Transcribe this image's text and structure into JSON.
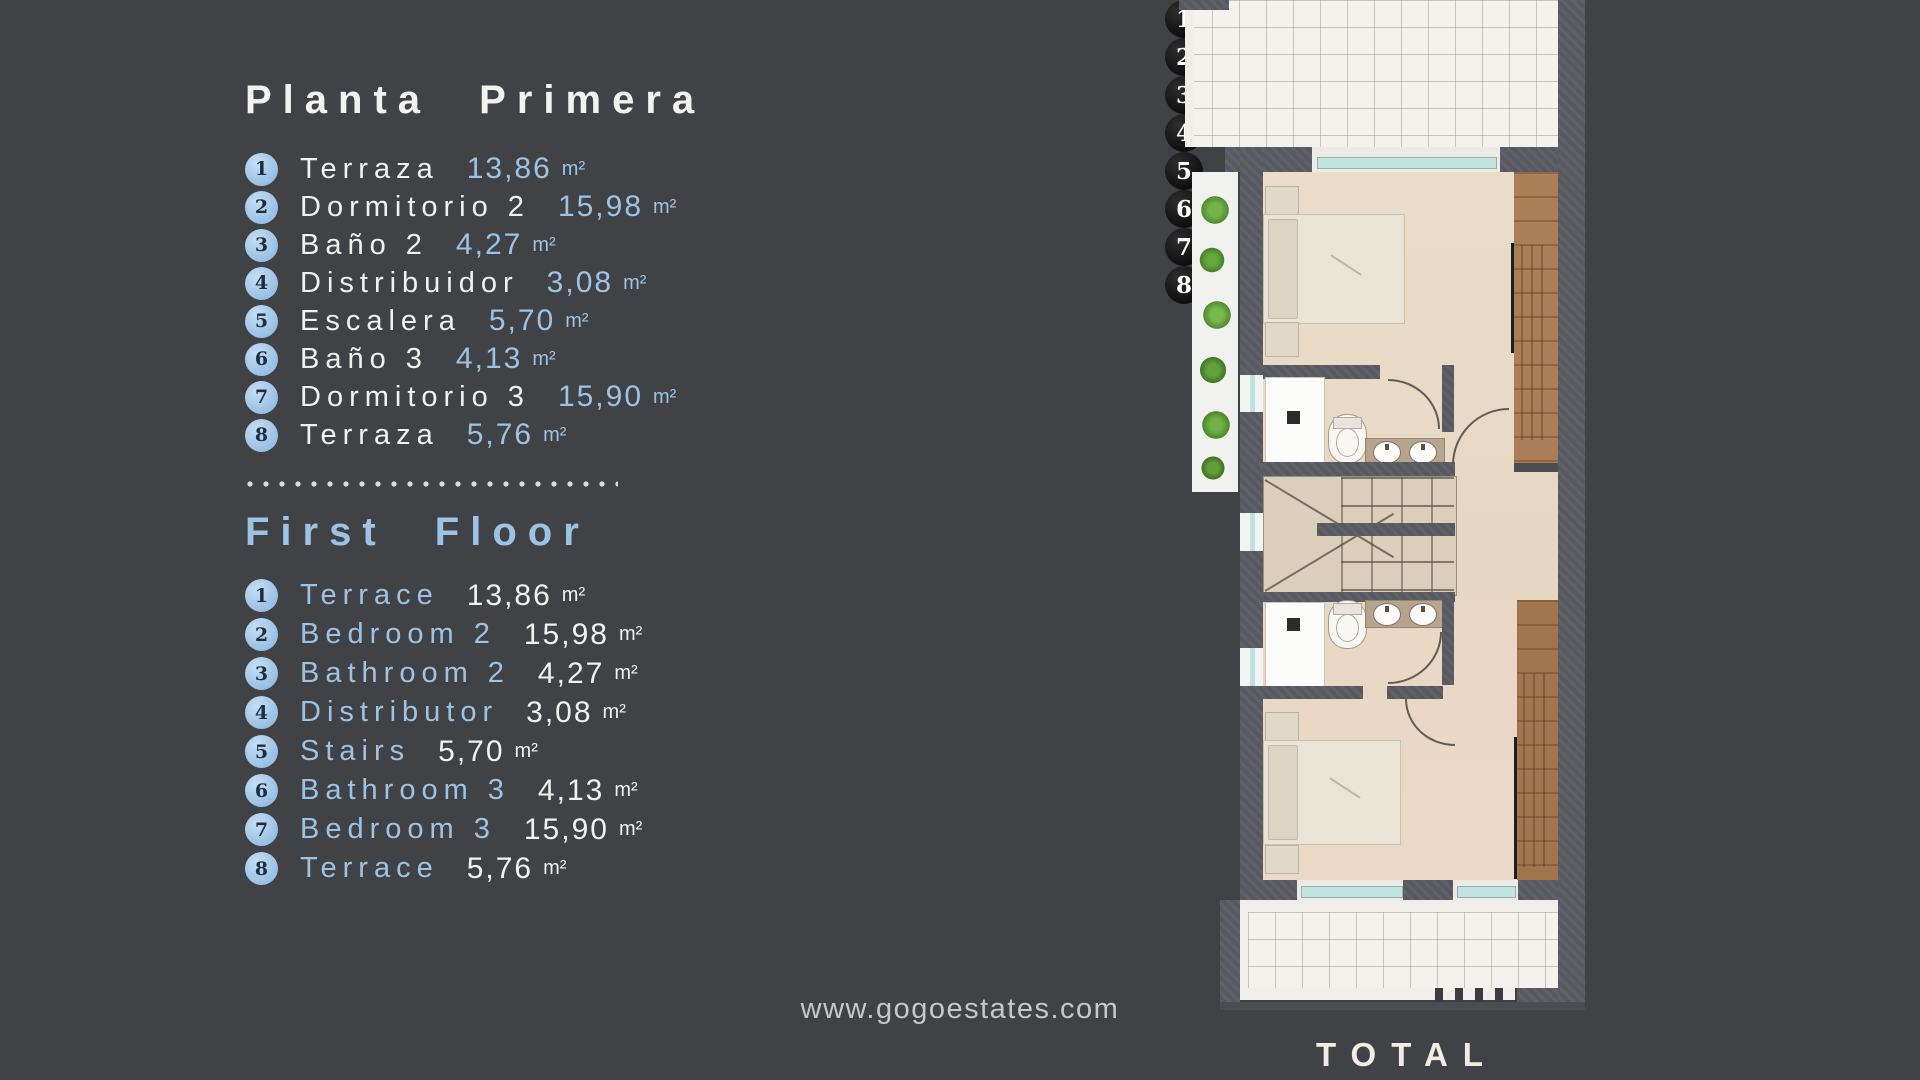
{
  "legend_es": {
    "title": "Planta Primera",
    "items": [
      {
        "num": "1",
        "name": "Terraza",
        "value": "13,86",
        "unit": "m²"
      },
      {
        "num": "2",
        "name": "Dormitorio 2",
        "value": "15,98",
        "unit": "m²"
      },
      {
        "num": "3",
        "name": "Baño 2",
        "value": "4,27",
        "unit": "m²"
      },
      {
        "num": "4",
        "name": "Distribuidor",
        "value": "3,08",
        "unit": "m²"
      },
      {
        "num": "5",
        "name": "Escalera",
        "value": "5,70",
        "unit": "m²"
      },
      {
        "num": "6",
        "name": "Baño 3",
        "value": "4,13",
        "unit": "m²"
      },
      {
        "num": "7",
        "name": "Dormitorio 3",
        "value": "15,90",
        "unit": "m²"
      },
      {
        "num": "8",
        "name": "Terraza",
        "value": "5,76",
        "unit": "m²"
      }
    ]
  },
  "legend_en": {
    "title": "First Floor",
    "items": [
      {
        "num": "1",
        "name": "Terrace",
        "value": "13,86",
        "unit": "m²"
      },
      {
        "num": "2",
        "name": "Bedroom 2",
        "value": "15,98",
        "unit": "m²"
      },
      {
        "num": "3",
        "name": "Bathroom 2",
        "value": "4,27",
        "unit": "m²"
      },
      {
        "num": "4",
        "name": "Distributor",
        "value": "3,08",
        "unit": "m²"
      },
      {
        "num": "5",
        "name": "Stairs",
        "value": "5,70",
        "unit": "m²"
      },
      {
        "num": "6",
        "name": "Bathroom 3",
        "value": "4,13",
        "unit": "m²"
      },
      {
        "num": "7",
        "name": "Bedroom 3",
        "value": "15,90",
        "unit": "m²"
      },
      {
        "num": "8",
        "name": "Terrace",
        "value": "5,76",
        "unit": "m²"
      }
    ]
  },
  "floorplan": {
    "markers": [
      "1",
      "2",
      "3",
      "4",
      "5",
      "6",
      "7",
      "8"
    ]
  },
  "footer": {
    "website": "www.gogoestates.com",
    "total_label": "TOTAL"
  },
  "colors": {
    "background": "#414245",
    "accent_blue": "#9cc3e5",
    "text_white": "#f1f1f0",
    "wall_gray": "#575860",
    "floor_beige": "#e8dcca",
    "terrace_white": "#f4f2ed",
    "window_teal": "#c2e3df",
    "plant_green": "#5f9e3a",
    "wood_brown": "#aa7e57",
    "marker_black": "#0d0d0d"
  }
}
